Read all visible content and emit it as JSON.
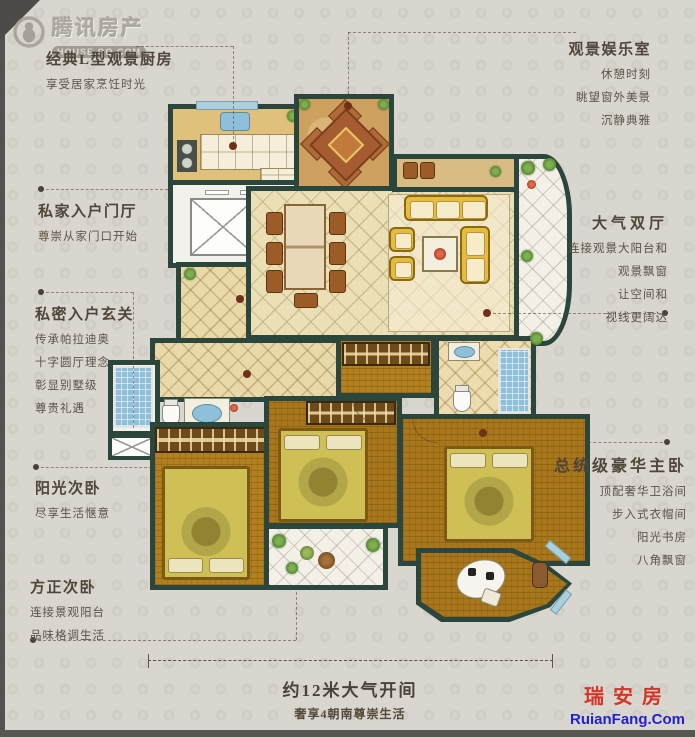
{
  "watermark_tencent": {
    "brand": "腾讯房产",
    "domain": "HOUSE.QQ.COM"
  },
  "watermark_ruian": {
    "brand": "瑞安房",
    "domain": "RuianFang.Com"
  },
  "annotations": {
    "kitchen": {
      "title": "经典L型观景厨房",
      "lines": [
        "享受居家烹饪时光"
      ]
    },
    "entertainment": {
      "title": "观景娱乐室",
      "lines": [
        "休憩时刻",
        "眺望窗外美景",
        "沉静典雅"
      ]
    },
    "entrance_hall": {
      "title": "私家入户门厅",
      "lines": [
        "尊崇从家门口开始"
      ]
    },
    "foyer": {
      "title": "私密入户玄关",
      "lines": [
        "传承帕拉迪奥",
        "十字圆厅理念",
        "彰显别墅级",
        "尊贵礼遇"
      ]
    },
    "double_hall": {
      "title": "大气双厅",
      "lines": [
        "连接观景大阳台和",
        "观景飘窗",
        "让空间和",
        "视线更阔达"
      ]
    },
    "sunny_bedroom": {
      "title": "阳光次卧",
      "lines": [
        "尽享生活惬意"
      ]
    },
    "square_bedroom": {
      "title": "方正次卧",
      "lines": [
        "连接景观阳台",
        "品味格调生活"
      ]
    },
    "master_bedroom": {
      "title": "总统级豪华主卧",
      "lines": [
        "顶配奢华卫浴间",
        "步入式衣帽间",
        "阳光书房",
        "八角飘窗"
      ]
    }
  },
  "dimension": {
    "label": "约12米大气开间",
    "sublabel": "奢享4朝南尊崇生活"
  },
  "colors": {
    "wall": "#2b463d",
    "annotation_text": "#564c40",
    "ruian_red": "#d43527",
    "ruian_blue": "#2222cc",
    "leader": "#4a4037",
    "room_dot": "#70301c"
  }
}
